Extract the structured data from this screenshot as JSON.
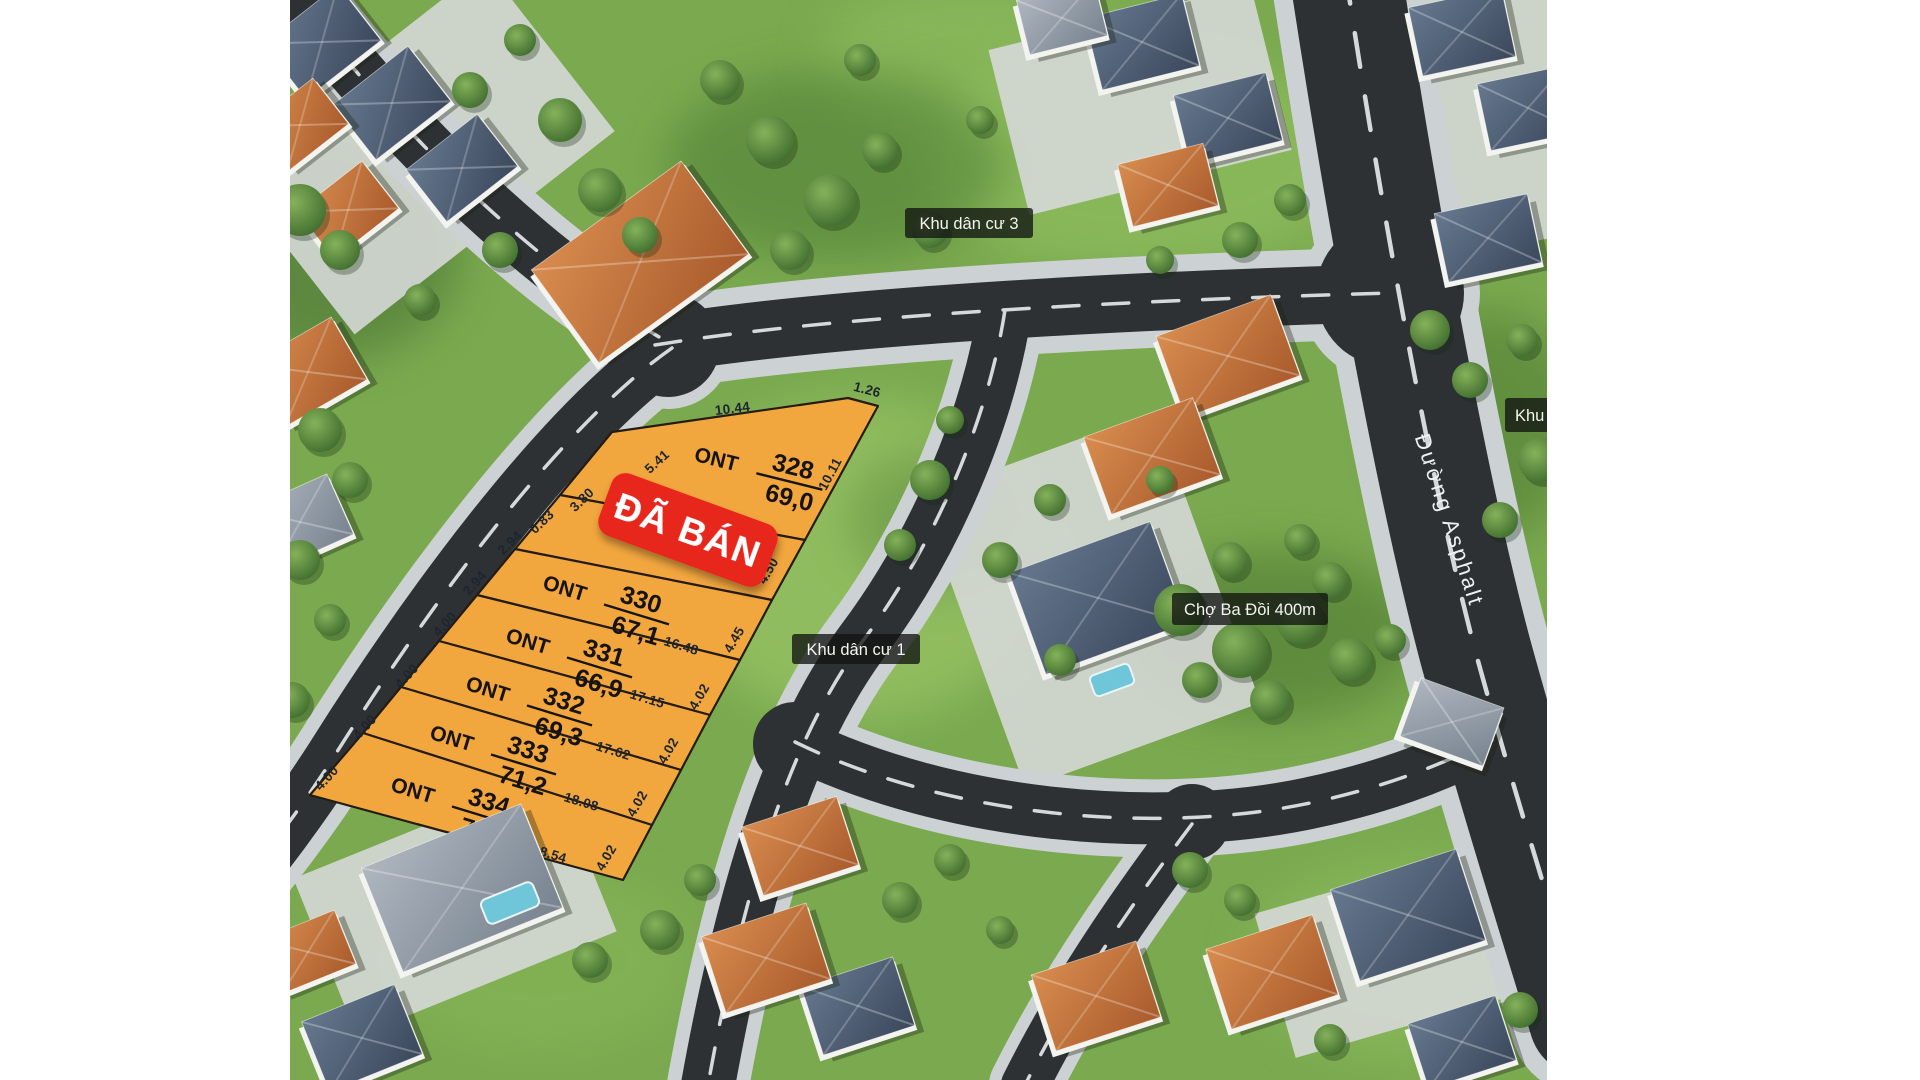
{
  "map": {
    "area_labels": {
      "residential_area_3": "Khu dân cư 3",
      "residential_area_1": "Khu dân cư 1",
      "market_distance": "Chợ Ba Đồi 400m",
      "clipped_right_label": "Khu d"
    },
    "road_name": "Đường Asphalt",
    "sold_badge_text": "ĐÃ BÁN",
    "plots": [
      {
        "code": "ONT",
        "number": "328",
        "area_m2": "69,0"
      },
      {
        "code": "ONT",
        "number": "330",
        "area_m2": "67,1"
      },
      {
        "code": "ONT",
        "number": "331",
        "area_m2": "66,9"
      },
      {
        "code": "ONT",
        "number": "332",
        "area_m2": "69,3"
      },
      {
        "code": "ONT",
        "number": "333",
        "area_m2": "71,2"
      },
      {
        "code": "ONT",
        "number": "334",
        "area_m2": "73,1"
      }
    ],
    "measurements": {
      "top_edge": [
        "10.44",
        "1.26"
      ],
      "right_edge": [
        "10.11",
        "4.50",
        "4.45",
        "4.02",
        "4.02",
        "4.02",
        "4.02"
      ],
      "dividers": [
        "12.12",
        "16.48",
        "17.15",
        "17.62",
        "18.08",
        "18.54"
      ],
      "road_edge": [
        "5.41",
        "3.80",
        "0.83",
        "2.94",
        "2.94",
        "4.00",
        "4.00",
        "4.00",
        "4.00"
      ]
    },
    "colors": {
      "plot_fill": "#f2a63e",
      "sold_badge": "#e7261d",
      "asphalt": "#2d3134",
      "sidewalk": "#ccd1d3",
      "grass": "#7aa94f",
      "label_bg": "rgba(18,20,18,0.78)"
    }
  }
}
